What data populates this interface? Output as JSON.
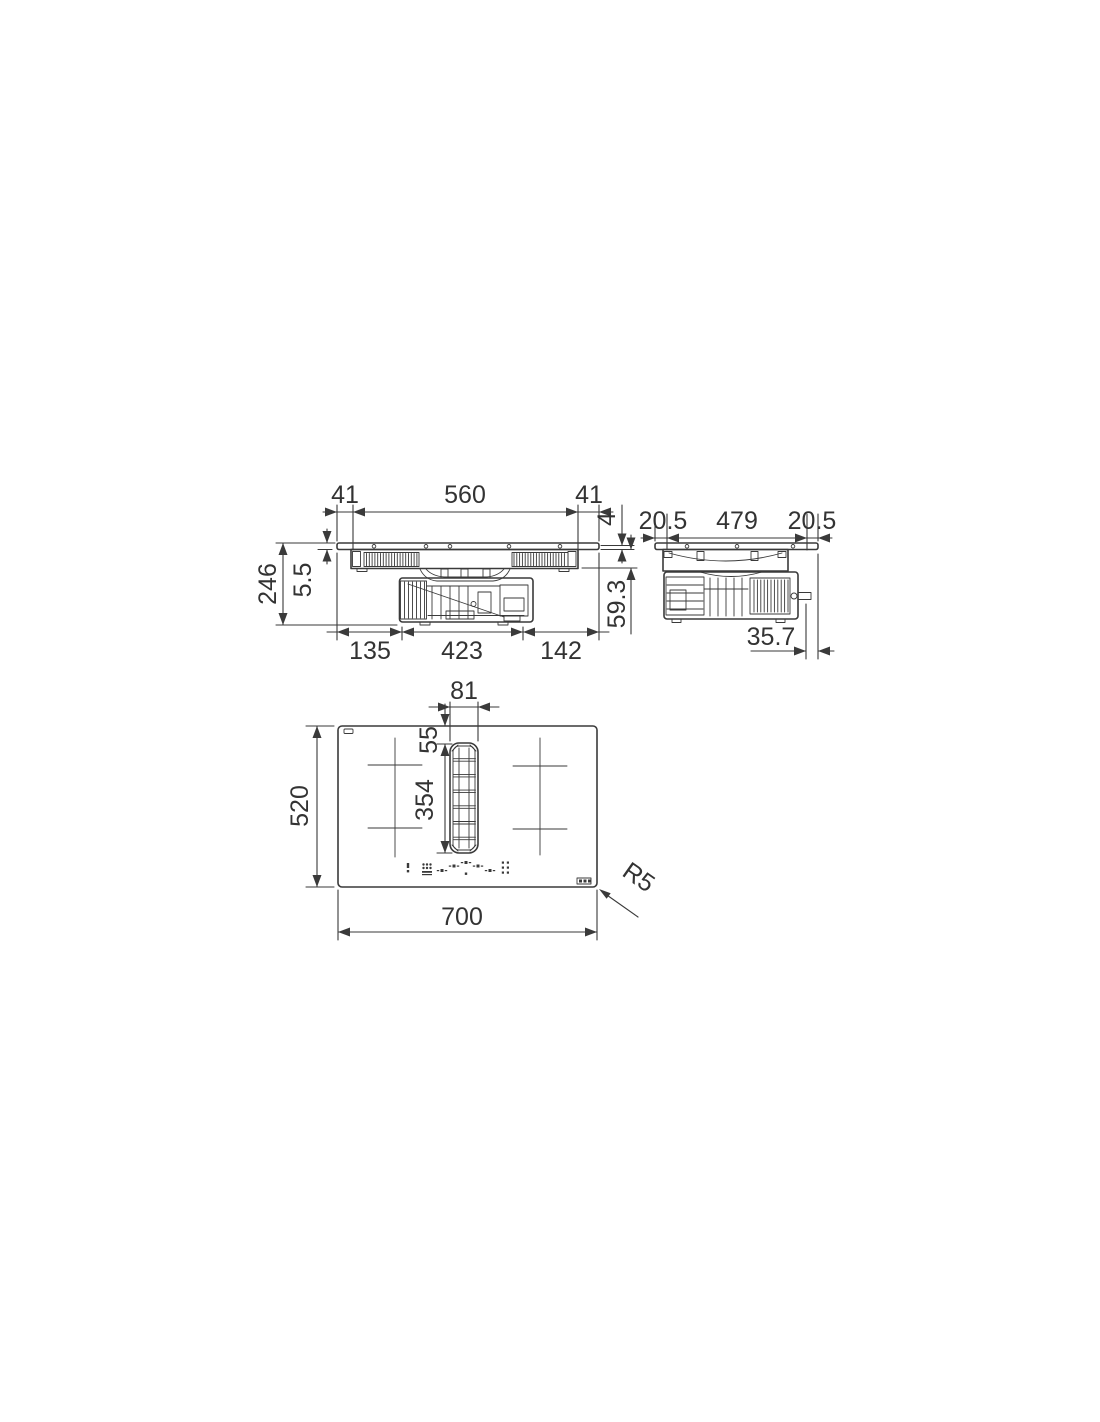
{
  "drawing": {
    "kind": "technical-dimension-drawing",
    "line_color": "#3a3a3a",
    "text_color": "#333333",
    "front": {
      "top": [
        "41",
        "560",
        "41"
      ],
      "right": [
        "4",
        "59.3"
      ],
      "left": [
        "246",
        "5.5"
      ],
      "bottom": [
        "135",
        "423",
        "142"
      ]
    },
    "side": {
      "top": [
        "20.5",
        "479",
        "20.5"
      ],
      "bottom": [
        "35.7"
      ]
    },
    "plan": {
      "top": [
        "81"
      ],
      "inner": [
        "55",
        "354"
      ],
      "left": [
        "520"
      ],
      "bottom": [
        "700"
      ],
      "corner_radius": "R5"
    }
  }
}
